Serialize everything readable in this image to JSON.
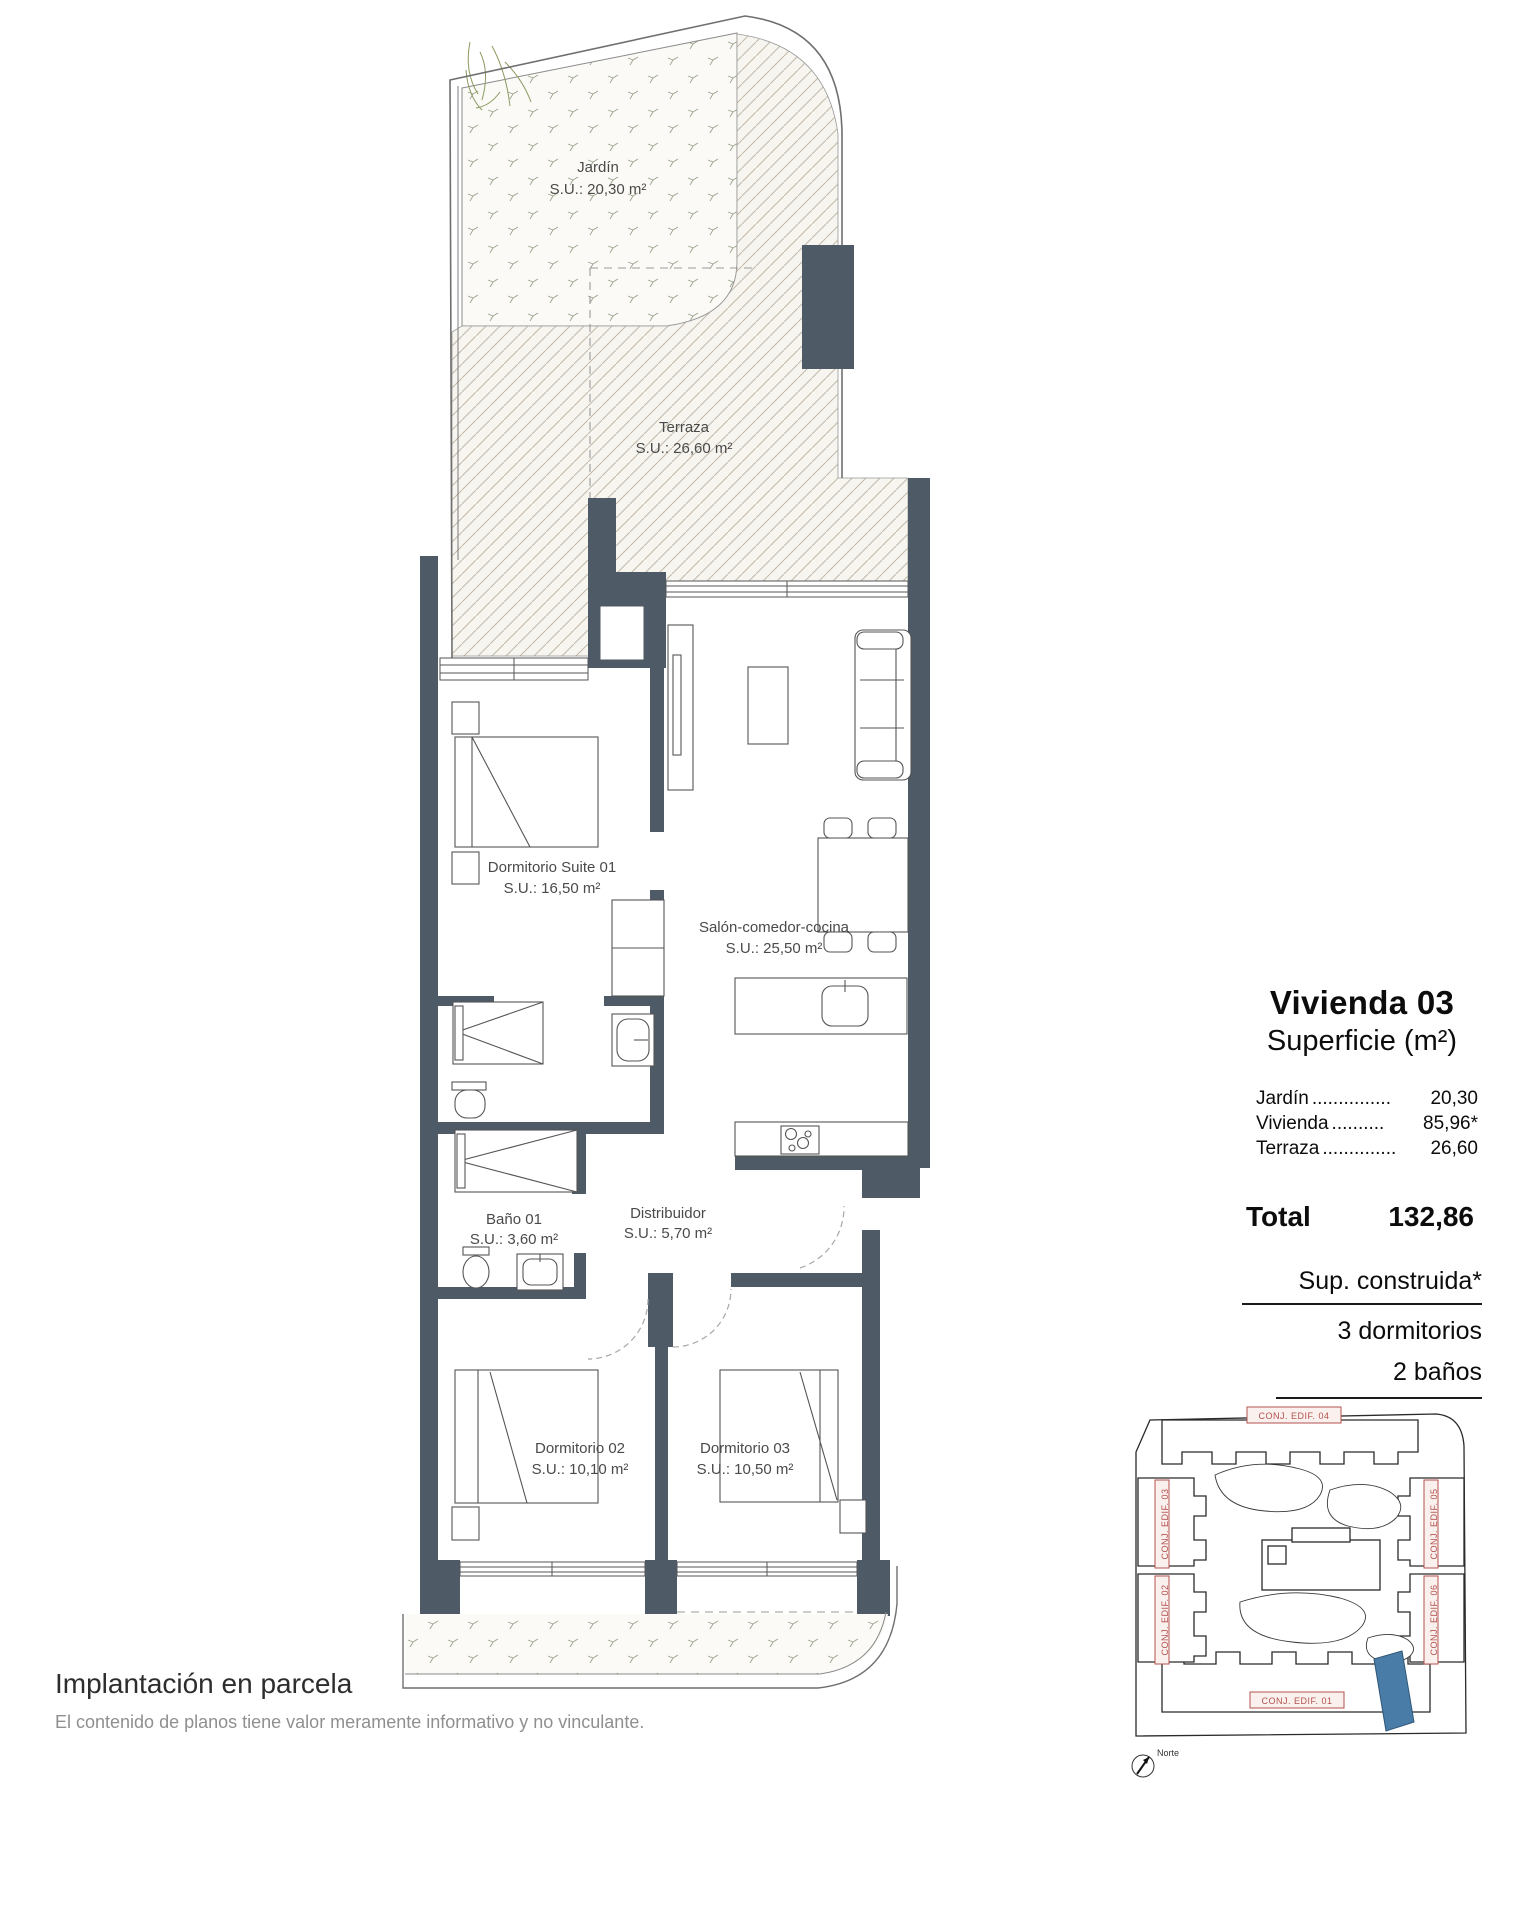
{
  "rooms": [
    {
      "name": "Jardín",
      "area": "S.U.: 20,30 m²"
    },
    {
      "name": "Terraza",
      "area": "S.U.: 26,60 m²"
    },
    {
      "name": "Dormitorio Suite 01",
      "area": "S.U.: 16,50 m²"
    },
    {
      "name": "Salón-comedor-cocina",
      "area": "S.U.: 25,50 m²"
    },
    {
      "name": "Baño 01",
      "area": "S.U.: 3,60 m²"
    },
    {
      "name": "Distribuidor",
      "area": "S.U.: 5,70 m²"
    },
    {
      "name": "Dormitorio 02",
      "area": "S.U.: 10,10 m²"
    },
    {
      "name": "Dormitorio 03",
      "area": "S.U.: 10,50 m²"
    }
  ],
  "panel": {
    "title": "Vivienda 03",
    "subtitle": "Superficie (m²)",
    "rows": [
      {
        "label": "Jardín",
        "dots": "...............",
        "value": "20,30"
      },
      {
        "label": "Vivienda",
        "dots": "..........",
        "value": "85,96*"
      },
      {
        "label": "Terraza",
        "dots": "..............",
        "value": "26,60"
      }
    ],
    "total_label": "Total",
    "total_value": "132,86",
    "note_title": "Sup. construida*",
    "note_line_1": "3 dormitorios",
    "note_line_2": "2 baños"
  },
  "site_plan": {
    "labels": [
      "CONJ. EDIF. 04",
      "CONJ. EDIF. 03",
      "CONJ. EDIF. 05",
      "CONJ. EDIF. 02",
      "CONJ. EDIF. 06",
      "CONJ. EDIF. 01"
    ],
    "north_label": "Norte",
    "highlight_color": "#4a7ca8",
    "label_color": "#b4524e"
  },
  "footer": {
    "title": "Implantación en parcela",
    "disclaimer": "El contenido de planos tiene valor meramente informativo y no vinculante."
  },
  "colors": {
    "wall": "#4e5a66",
    "hatch_line": "#c2b9aa",
    "hatch_bg": "#f7f5ef"
  }
}
